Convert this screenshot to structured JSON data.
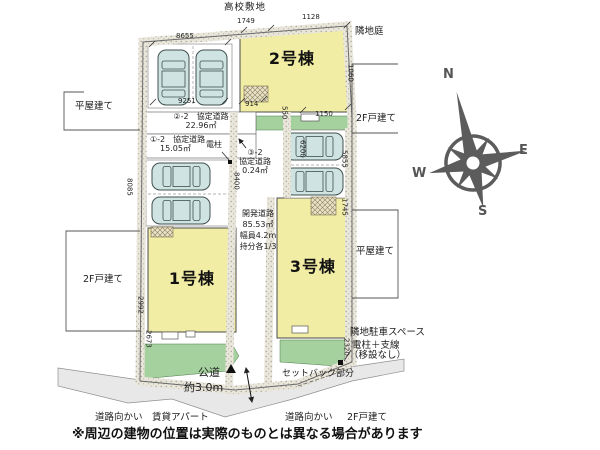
{
  "plan": {
    "top_label": "高校敷地",
    "note": "※周辺の建物の位置は実際のものとは異なる場合があります",
    "buildings": {
      "b1": "1号棟",
      "b2": "2号棟",
      "b3": "3号棟"
    },
    "agreement_roads": {
      "r2_name": "②-2　協定道路",
      "r2_area": "22.96㎡",
      "r1_name": "①-2　協定道路",
      "r1_area": "15.05㎡",
      "r3_no": "③-2",
      "r3_name": "協定道路",
      "r3_area": "0.24㎡"
    },
    "development_road": {
      "name": "開発道路",
      "area": "85.53㎡",
      "width": "幅員4.2m",
      "share": "持分各1/3"
    },
    "public_road": {
      "name": "公道",
      "width": "約3.0m"
    },
    "pole_label": "電柱",
    "setback_label": "セットバック部分",
    "neighbors": {
      "right_garden": "隣地庭",
      "right_upper": "2F戸建て",
      "right_middle": "平屋建て",
      "right_parking": "隣地駐車スペース",
      "pole_line1": "電柱＋支線",
      "pole_line2": "（移設なし）",
      "left_upper": "平屋建て",
      "left_lower": "2F戸建て",
      "across_left": "道路向かい",
      "across_left_building": "賃貸アパート",
      "across_right": "道路向かい",
      "across_right_building": "2F戸建て"
    },
    "dimensions": {
      "top_width": "8655",
      "parking_width": "9251",
      "entry_width": "914",
      "b2_top_left": "1749",
      "b2_top_right": "1128",
      "b2_right_side": "1060",
      "green_strip": "550",
      "b2_bottom": "1150",
      "parking_depth": "8400",
      "west_side": "8085",
      "road_side": "6200",
      "east_parking": "5855",
      "east_steps": "1745",
      "b1_west": "2992",
      "b1_west_lower": "2673",
      "b3_east": "2320"
    },
    "compass": {
      "n": "N",
      "e": "E",
      "w": "W",
      "s": "S"
    },
    "colors": {
      "building_fill": "#F2EDA4",
      "green_fill": "#A5D19E",
      "car_fill": "#CEE3E2",
      "road_fill": "#E8E8E8"
    }
  }
}
